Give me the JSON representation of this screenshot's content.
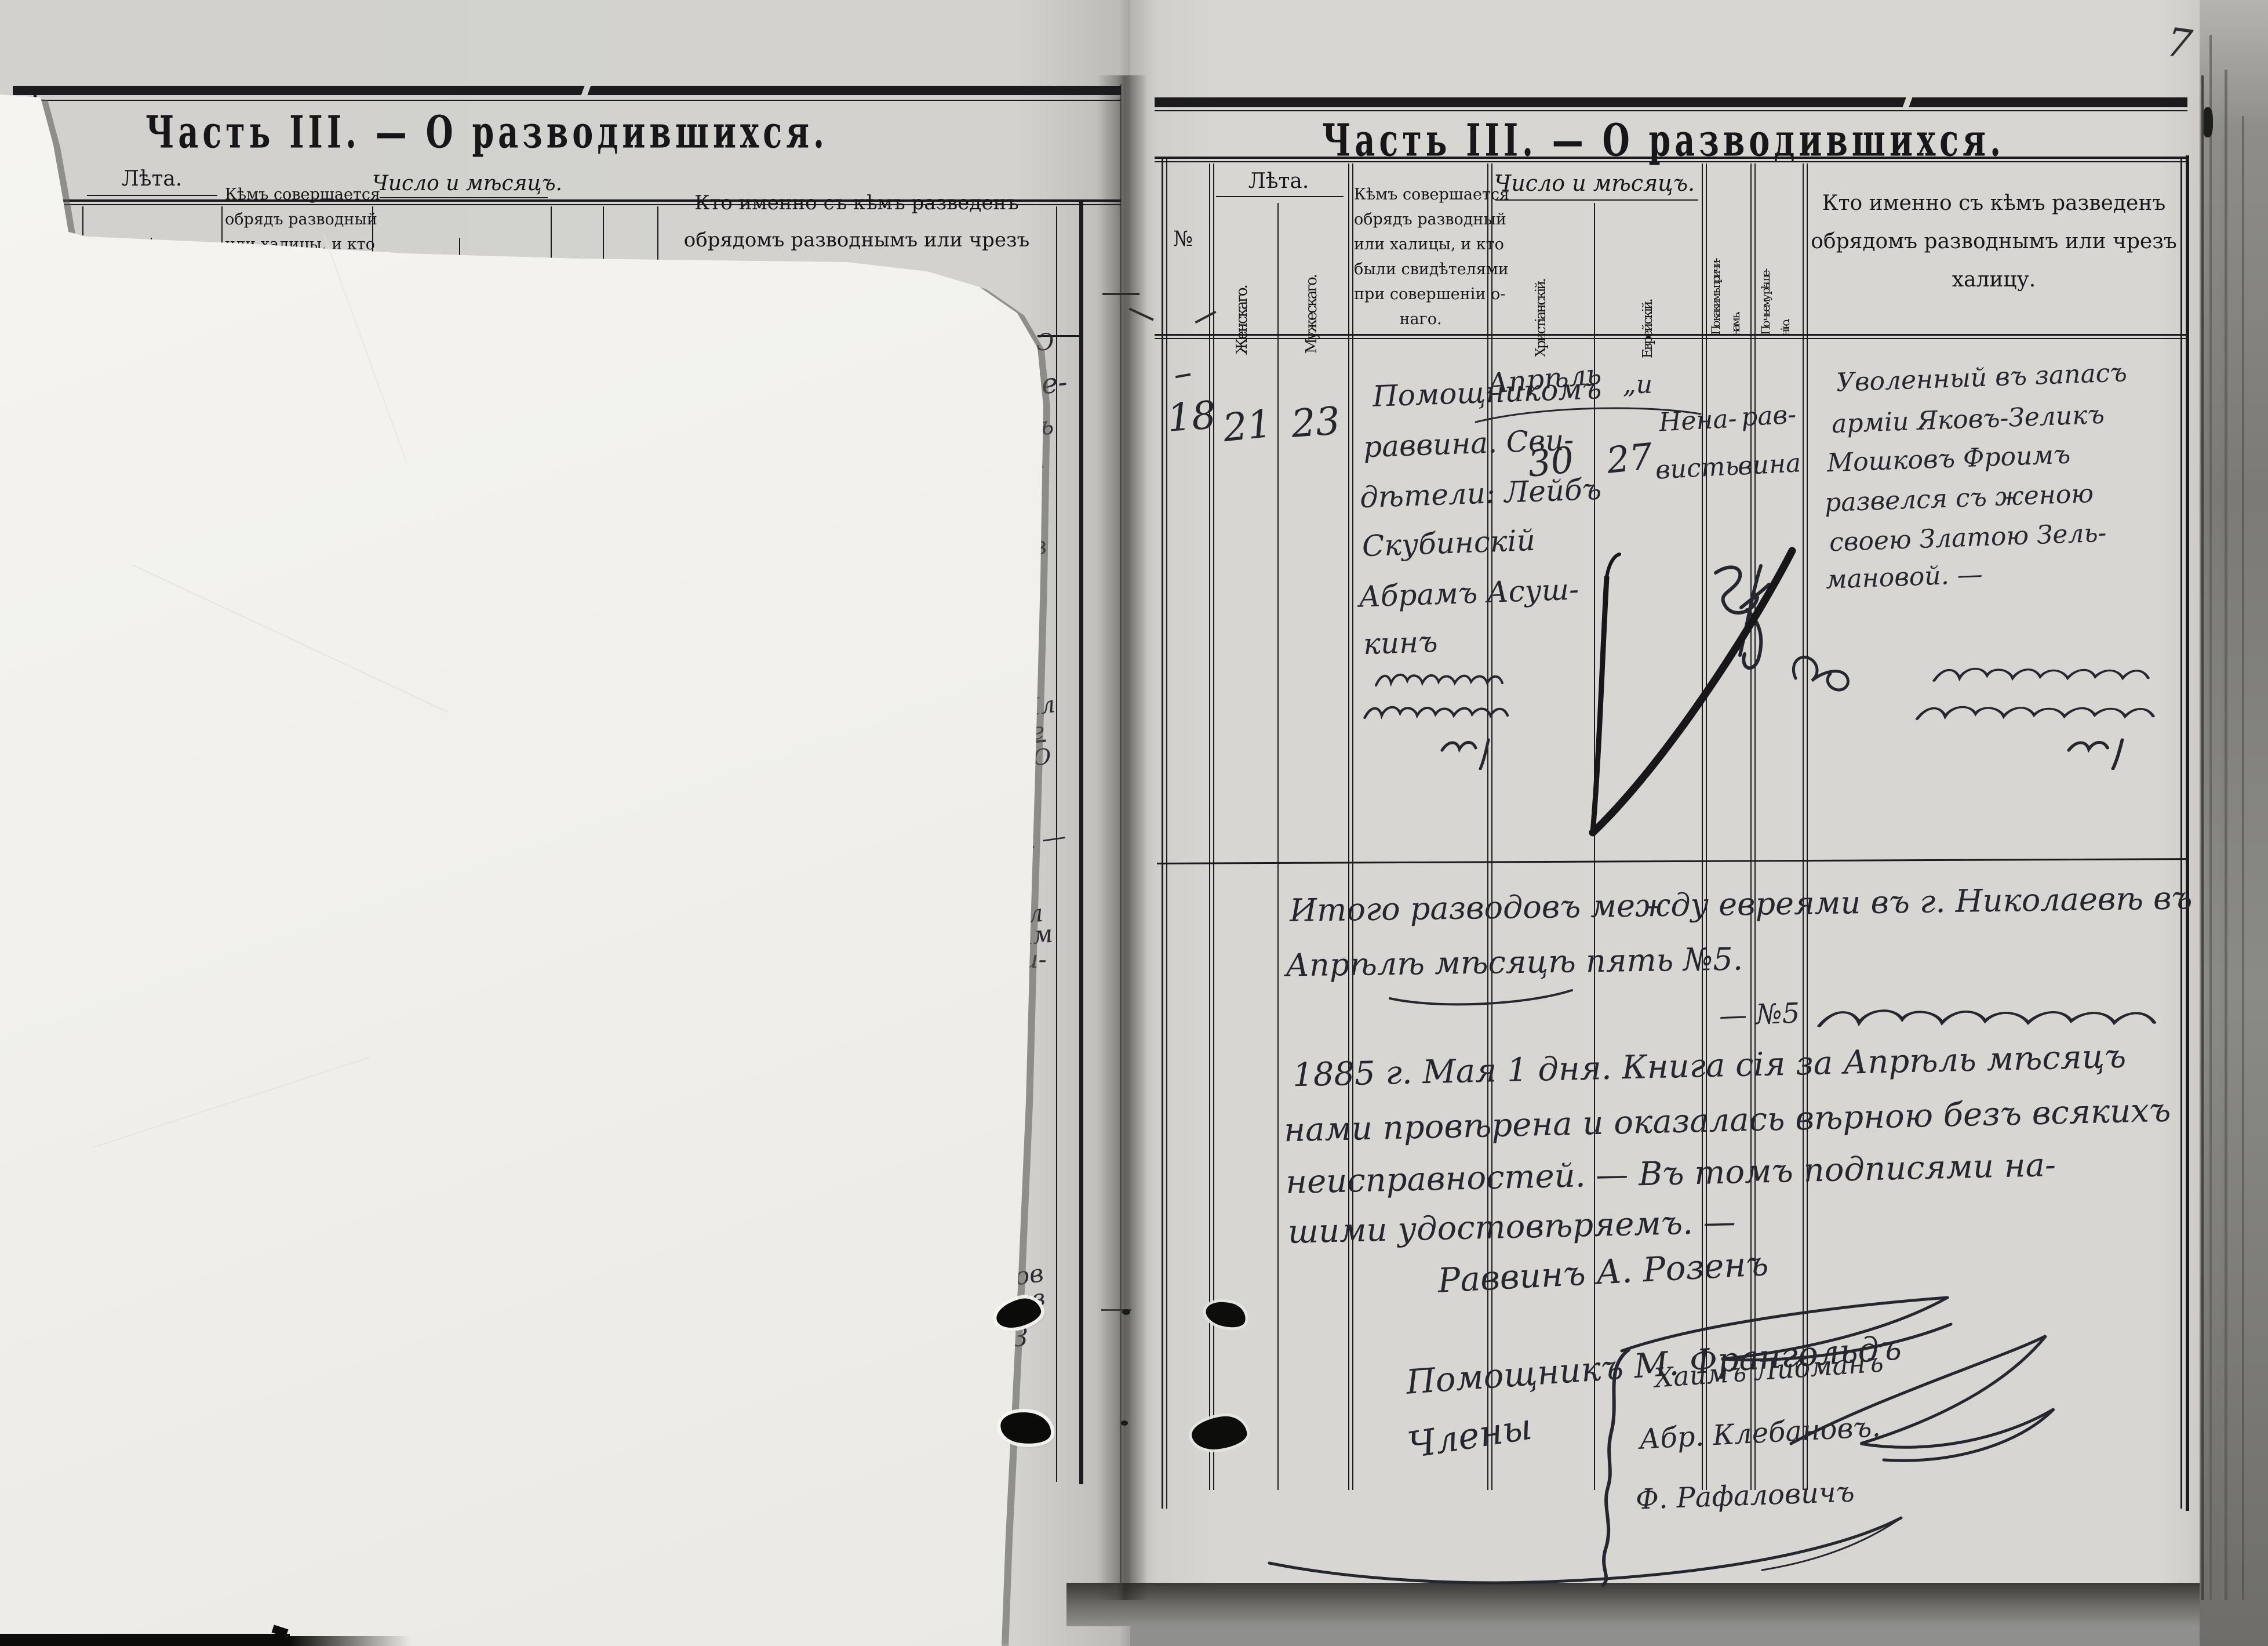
{
  "scan": {
    "page_number": "7"
  },
  "colors": {
    "paper_left": "#d3d2ce",
    "paper_right": "#d7d6d2",
    "overlay_sheet": "#f3f2ee",
    "print_ink": "#17171a",
    "handwriting_ink": "#26262e"
  },
  "form_headers": {
    "no": "№",
    "leta": "Лѣта.",
    "zhenskago": "Женскаго.",
    "muzheskago": "Мужескаго.",
    "kem": [
      "Кѣмъ совершается",
      "обрядъ разводный",
      "или халицы, и кто",
      "были свидѣтелями",
      "при совершеніи о-",
      "наго."
    ],
    "chislo": "Число и мѣсяцъ.",
    "khristianskiy": "Христіанскій.",
    "evreyskiy": "Еврейскій.",
    "prichinam_1": "По какимъ причи-",
    "prichinam_2": "намъ.",
    "resheniyu_1": "По чьему рѣше-",
    "resheniyu_2": "нію.",
    "kto": [
      "Кто именно съ кѣмъ разведенъ",
      "обрядомъ разводнымъ или чрезъ",
      "халицу."
    ]
  },
  "left_page": {
    "title": "Часть III. — О разводившихся.",
    "fragments": [
      "Ɔ",
      "Ше-",
      "мъ",
      "—",
      "о",
      "ов",
      "Ил",
      "Зе",
      ".Ю",
      "ик —",
      "ь",
      "Ь",
      "ел",
      "вим",
      "ви-",
      "сд",
      "дов",
      "ив",
      "З"
    ]
  },
  "right_page": {
    "title": "Часть III. — О разводившихся.",
    "entry": {
      "no": "18",
      "age_female": "21",
      "age_male": "23",
      "officiant_lines": [
        "Помощникомъ",
        "раввина. Сви-",
        "дѣтели: Лейбъ",
        "Скубинскій",
        "Абрамъ Асуш-",
        "кинъ"
      ],
      "month_christian": "Апрѣль",
      "ditto_hebrew": "„и",
      "day_christian": "30",
      "day_hebrew": "27",
      "cause_lines": [
        "Нена-",
        "висть"
      ],
      "decision_lines": [
        "рав-",
        "вина"
      ],
      "divorced_lines": [
        "Уволенный въ запасъ",
        "арміи Яковъ-Зеликъ",
        "Мошковъ Фроимъ",
        "развелся съ женою",
        "своею Златою Зель-",
        "мановой. —"
      ]
    },
    "summary": {
      "total_line_1": "Итого разводовъ между евреями въ г. Николаевѣ въ",
      "total_line_2": "Апрѣлѣ мѣсяцѣ пять №5.",
      "hebrew_ref": "— №5",
      "verification_lines": [
        "1885 г. Мая 1 дня. Книга сія за Апрѣль мѣсяцъ",
        "нами провѣрена и оказалась вѣрною безъ всякихъ",
        "неисправностей. — Въ томъ подписями на-",
        "шими удостовѣряемъ. —"
      ],
      "sig_rabbi": "Раввинъ А. Розенъ",
      "sig_assistant": "Помощникъ М. Франгольдъ",
      "members_label": "Члены",
      "members": [
        "Хаимъ Либманъ",
        "Абр. Клебановъ.",
        "Ф. Рафаловичъ"
      ]
    },
    "hebrew_script_lines": {
      "officiant_cell": 3,
      "divorced_cell": 3,
      "summary_line": 1,
      "cause_mark": 1,
      "decision_mark": 1
    }
  }
}
